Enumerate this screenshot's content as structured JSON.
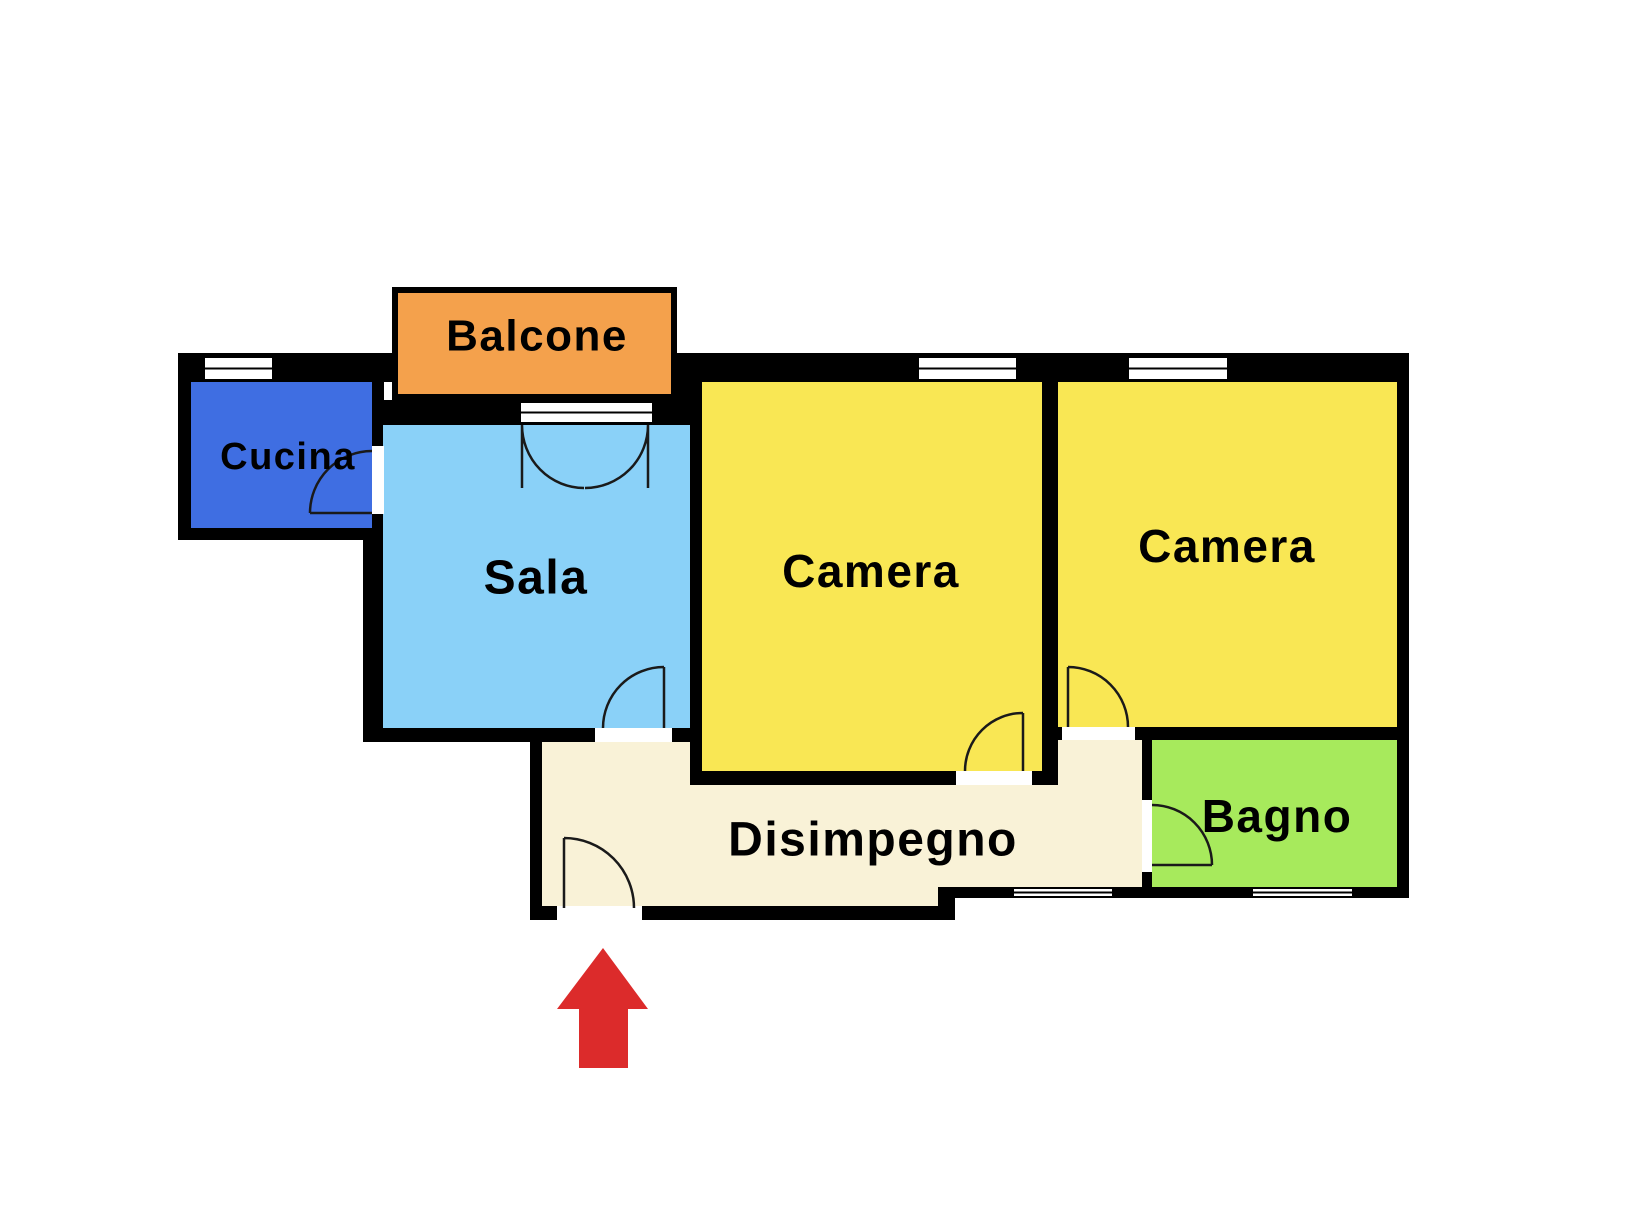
{
  "plan": {
    "background_color": "#ffffff",
    "wall_color": "#000000",
    "window_color": "#ffffff",
    "rooms": {
      "balcone": {
        "label": "Balcone",
        "color": "#F4A14C"
      },
      "cucina": {
        "label": "Cucina",
        "color": "#3F6EE2"
      },
      "sala": {
        "label": "Sala",
        "color": "#8AD1F8"
      },
      "camera1": {
        "label": "Camera",
        "color": "#F9E754"
      },
      "camera2": {
        "label": "Camera",
        "color": "#F9E754"
      },
      "bagno": {
        "label": "Bagno",
        "color": "#A7EA5C"
      },
      "disimpegno": {
        "label": "Disimpegno",
        "color": "#F9F2D7"
      }
    },
    "entrance_arrow": {
      "color": "#DC2B2B",
      "direction": "up"
    }
  }
}
